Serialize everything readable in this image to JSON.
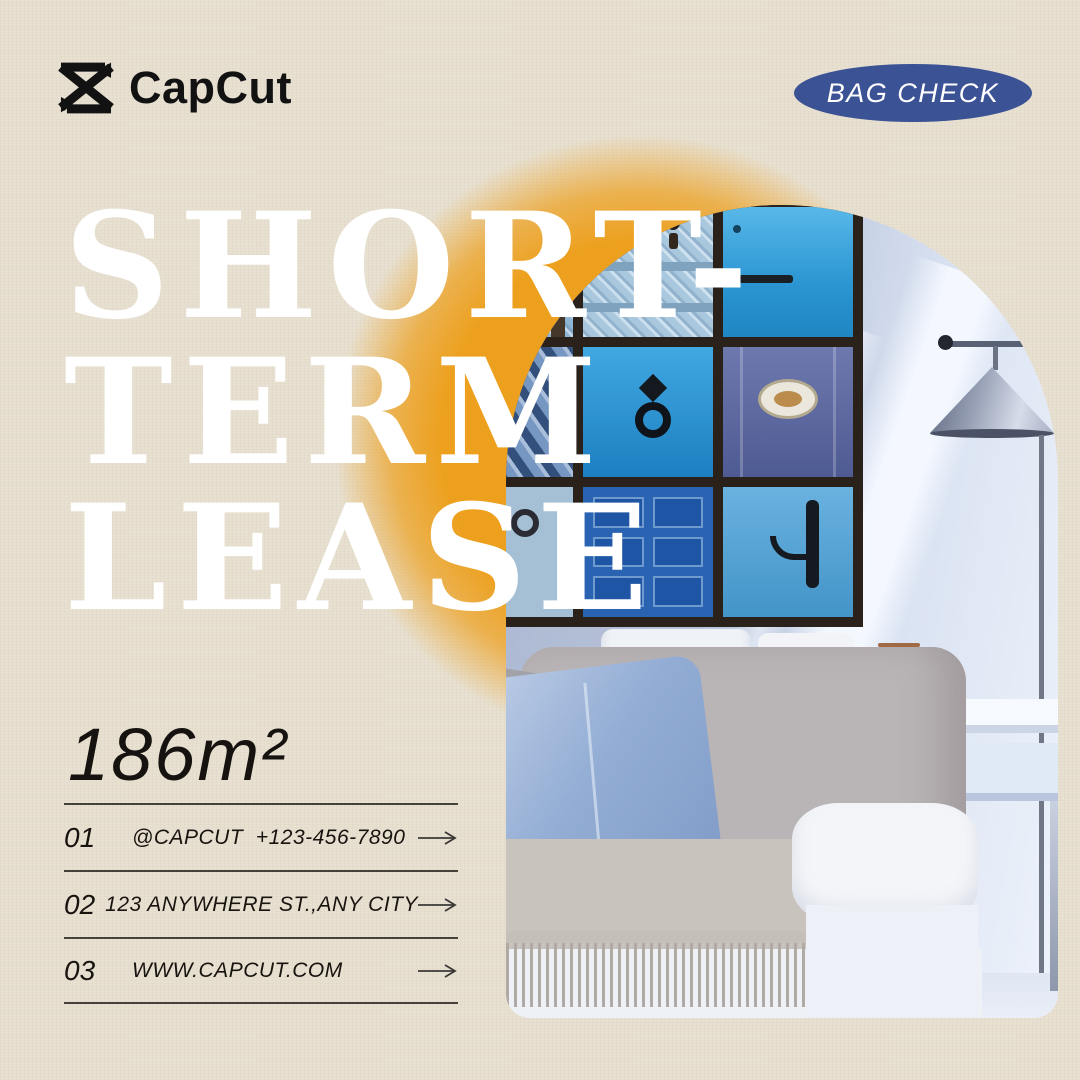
{
  "brand": {
    "name": "CapCut"
  },
  "badge": {
    "label": "BAG CHECK"
  },
  "headline": {
    "lines": [
      "SHORT-",
      "TERM",
      "LEASE"
    ]
  },
  "area_label": "186m²",
  "contacts": {
    "items": [
      {
        "index": "01",
        "text": "@CAPCUT  +123-456-7890"
      },
      {
        "index": "02",
        "text": "123 ANYWHERE ST.,ANY CITY"
      },
      {
        "index": "03",
        "text": "WWW.CAPCUT.COM"
      }
    ]
  },
  "colors": {
    "background": "#e8e1d1",
    "glow_orange": "#eda01e",
    "badge_bg": "#3b5295",
    "badge_text": "#ffffff",
    "headline": "#ffffff",
    "body_text": "#17140f",
    "divider": "#45423e"
  }
}
